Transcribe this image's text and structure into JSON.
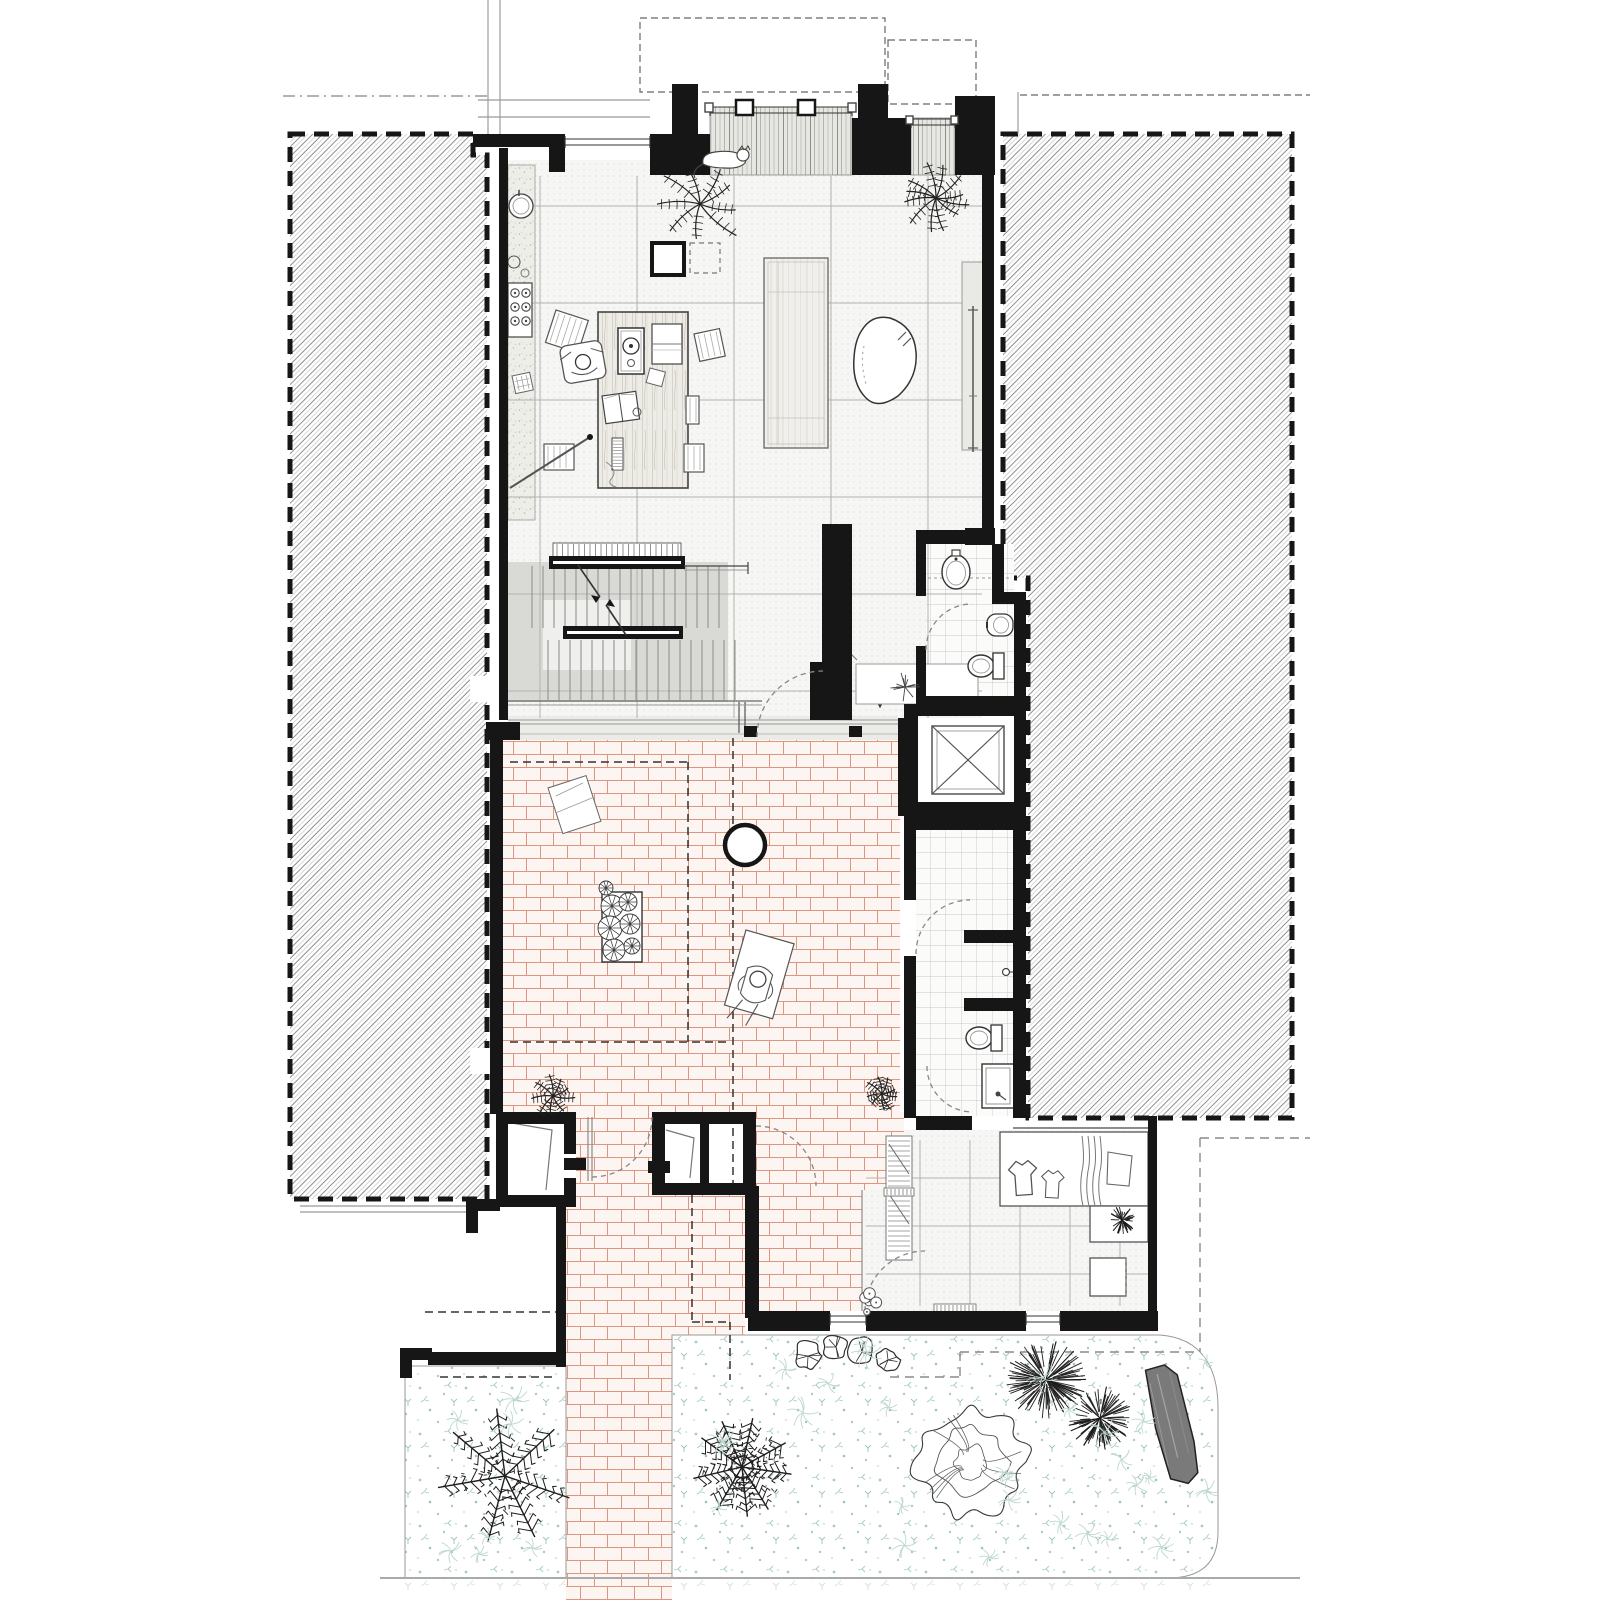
{
  "document": {
    "kind": "architectural ground floor plan",
    "visible_text": [],
    "notes": "line drawing, no labels or dimensions visible"
  },
  "colors": {
    "wall": "#161616",
    "line_dark": "#333333",
    "line_mid": "#777777",
    "line_light": "#aaaaaa",
    "hatch": "#8f8f8f",
    "tile_bg": "#f6f6f4",
    "tile_dot": "#c9c9c3",
    "grid": "#b2b2ad",
    "stair_grey": "#d9d9d6",
    "deck_bg": "#e6e6e2",
    "deck_line": "#a8a8a2",
    "brick_joint": "#dd9680",
    "brick_bg": "#fdf5f1",
    "teal": "#a6cdbf",
    "teal_light": "#bdd8cc",
    "wood_bg": "#edece7",
    "wood_line": "#c9c5b8",
    "speckle_bg": "#eeeee9",
    "log_fill": "#7a7a7a"
  },
  "canvas": {
    "width": 1600,
    "height": 1600
  },
  "hatch_blocks": [
    {
      "name": "party-wall-left",
      "path": "M290,134 L473,134 L473,155 L487,155 L487,1199 L290,1199 Z"
    },
    {
      "name": "party-wall-right",
      "path": "M1003,134 L1292,134 L1292,1118 L1028,1118 L1028,578 L1003,578 Z"
    }
  ],
  "hatch_notches": [
    [
      470,
      676,
      20,
      26
    ],
    [
      470,
      1048,
      20,
      26
    ]
  ],
  "floors": {
    "main_tile": [
      508,
      160,
      474,
      558
    ],
    "kitchen_strip": [
      508,
      165,
      27,
      355
    ],
    "deck_bays": [
      [
        710,
        107,
        142,
        68
      ],
      [
        911,
        118,
        44,
        57
      ]
    ],
    "threshold": [
      508,
      716,
      390,
      24
    ],
    "stair_grey": [
      508,
      562,
      220,
      140
    ],
    "stair_landing": [
      543,
      600,
      88,
      70
    ],
    "wc_tile": [
      926,
      544,
      88,
      152
    ],
    "bath_tile": [
      916,
      830,
      97,
      286
    ],
    "laundry_tile": [
      [
        904,
        1130,
        244,
        60
      ],
      [
        862,
        1190,
        286,
        121
      ]
    ],
    "shaft_inner": [
      932,
      726,
      72,
      68
    ],
    "bricks": [
      [
        503,
        736,
        397,
        376
      ],
      [
        576,
        1112,
        76,
        83
      ],
      [
        756,
        1112,
        148,
        78
      ],
      [
        759,
        1186,
        103,
        125
      ],
      [
        566,
        1195,
        179,
        140
      ],
      [
        566,
        1335,
        106,
        265
      ]
    ],
    "bed_left": [
      405,
      1366,
      161,
      212
    ],
    "bed_right_path": "M672,1335 L1160,1335 C1202,1338 1218,1368 1218,1408 L1218,1532 Q1218,1578 1168,1578 L672,1578 Z",
    "teal_below": [
      [
        405,
        1578,
        161,
        14
      ],
      [
        672,
        1578,
        546,
        14
      ]
    ]
  },
  "grids": {
    "main": {
      "vx": [
        540,
        637,
        734,
        831,
        928
      ],
      "vy1": 176,
      "vy2": 718,
      "hy": [
        206,
        303,
        400,
        497,
        594,
        691
      ],
      "hx1": 508,
      "hx2": 982
    },
    "laundry": {
      "vx": [
        920,
        970,
        1020,
        1070,
        1120
      ],
      "vy1": 1140,
      "vy2": 1306,
      "hy": [
        1178,
        1226,
        1274
      ],
      "hx1": 866,
      "hx2": 1148
    }
  },
  "walls": [
    [
      473,
      134,
      92,
      13
    ],
    [
      549,
      147,
      16,
      25
    ],
    [
      499,
      148,
      9,
      572
    ],
    [
      672,
      84,
      26,
      52
    ],
    [
      650,
      134,
      60,
      41
    ],
    [
      858,
      84,
      30,
      36
    ],
    [
      852,
      118,
      59,
      57
    ],
    [
      955,
      96,
      40,
      79
    ],
    [
      982,
      175,
      12,
      353
    ],
    [
      965,
      528,
      30,
      17
    ],
    [
      916,
      530,
      51,
      14
    ],
    [
      992,
      544,
      12,
      50
    ],
    [
      992,
      592,
      34,
      12
    ],
    [
      1014,
      592,
      12,
      120
    ],
    [
      916,
      696,
      104,
      10
    ],
    [
      916,
      530,
      10,
      66
    ],
    [
      916,
      646,
      10,
      60
    ],
    [
      904,
      704,
      14,
      112
    ],
    [
      916,
      704,
      104,
      12
    ],
    [
      1014,
      704,
      12,
      112
    ],
    [
      904,
      802,
      122,
      14
    ],
    [
      822,
      524,
      30,
      196
    ],
    [
      810,
      662,
      14,
      58
    ],
    [
      490,
      736,
      13,
      378
    ],
    [
      486,
      722,
      34,
      18
    ],
    [
      898,
      718,
      20,
      98
    ],
    [
      904,
      815,
      112,
      15
    ],
    [
      904,
      830,
      12,
      70
    ],
    [
      904,
      956,
      12,
      162
    ],
    [
      1013,
      815,
      13,
      303
    ],
    [
      964,
      930,
      50,
      13
    ],
    [
      964,
      998,
      50,
      13
    ],
    [
      916,
      1116,
      56,
      14
    ],
    [
      1148,
      1116,
      9,
      202
    ],
    [
      745,
      1186,
      14,
      132
    ],
    [
      748,
      1311,
      82,
      20
    ],
    [
      866,
      1311,
      160,
      20
    ],
    [
      1060,
      1311,
      98,
      20
    ],
    [
      496,
      1112,
      80,
      12
    ],
    [
      496,
      1112,
      12,
      95
    ],
    [
      496,
      1195,
      80,
      12
    ],
    [
      564,
      1112,
      12,
      42
    ],
    [
      564,
      1178,
      12,
      29
    ],
    [
      564,
      1158,
      22,
      12
    ],
    [
      652,
      1112,
      104,
      12
    ],
    [
      652,
      1112,
      13,
      83
    ],
    [
      652,
      1183,
      104,
      12
    ],
    [
      743,
      1112,
      13,
      83
    ],
    [
      700,
      1124,
      9,
      59
    ],
    [
      648,
      1161,
      22,
      12
    ],
    [
      556,
      1195,
      10,
      172
    ],
    [
      466,
      1199,
      34,
      12
    ],
    [
      466,
      1199,
      12,
      34
    ],
    [
      400,
      1348,
      32,
      12
    ],
    [
      400,
      1348,
      12,
      30
    ],
    [
      428,
      1352,
      138,
      13
    ],
    [
      744,
      726,
      13,
      11
    ],
    [
      849,
      726,
      13,
      11
    ]
  ],
  "thin_lines": [
    {
      "x1": 488,
      "y1": 0,
      "x2": 488,
      "y2": 134,
      "c": "#888",
      "w": 1
    },
    {
      "x1": 500,
      "y1": 0,
      "x2": 500,
      "y2": 134,
      "c": "#888",
      "w": 1
    },
    {
      "x1": 478,
      "y1": 100,
      "x2": 650,
      "y2": 100,
      "c": "#999",
      "w": 1.2
    },
    {
      "x1": 478,
      "y1": 117,
      "x2": 650,
      "y2": 117,
      "c": "#999",
      "w": 1.2
    },
    {
      "x1": 1018,
      "y1": 92,
      "x2": 1018,
      "y2": 134,
      "c": "#888",
      "w": 1
    },
    {
      "x1": 300,
      "y1": 1206,
      "x2": 466,
      "y2": 1206,
      "c": "#999",
      "w": 1.2
    },
    {
      "x1": 300,
      "y1": 1212,
      "x2": 466,
      "y2": 1212,
      "c": "#999",
      "w": 1.2
    },
    {
      "x1": 380,
      "y1": 1578,
      "x2": 1300,
      "y2": 1578,
      "c": "#aaa",
      "w": 2
    },
    {
      "x1": 862,
      "y1": 1190,
      "x2": 862,
      "y2": 1311,
      "c": "#777",
      "w": 1
    },
    {
      "x1": 1013,
      "y1": 1128,
      "x2": 1148,
      "y2": 1128,
      "c": "#666",
      "w": 1.5
    },
    {
      "x1": 508,
      "y1": 720,
      "x2": 898,
      "y2": 720,
      "c": "#999",
      "w": 1
    },
    {
      "x1": 508,
      "y1": 724,
      "x2": 898,
      "y2": 724,
      "c": "#999",
      "w": 1
    },
    {
      "x1": 508,
      "y1": 734,
      "x2": 898,
      "y2": 734,
      "c": "#bbb",
      "w": 1
    },
    {
      "x1": 739,
      "y1": 702,
      "x2": 739,
      "y2": 733,
      "c": "#555",
      "w": 1.2
    },
    {
      "x1": 745,
      "y1": 702,
      "x2": 745,
      "y2": 733,
      "c": "#555",
      "w": 1.2
    },
    {
      "x1": 508,
      "y1": 701,
      "x2": 762,
      "y2": 701,
      "c": "#666",
      "w": 1.2
    },
    {
      "x1": 508,
      "y1": 705,
      "x2": 762,
      "y2": 705,
      "c": "#999",
      "w": 1
    },
    {
      "x1": 684,
      "y1": 566,
      "x2": 748,
      "y2": 566,
      "c": "#444",
      "w": 1.2
    },
    {
      "x1": 684,
      "y1": 570,
      "x2": 748,
      "y2": 570,
      "c": "#999",
      "w": 1
    },
    {
      "x1": 748,
      "y1": 562,
      "x2": 748,
      "y2": 574,
      "c": "#444",
      "w": 1.2
    }
  ],
  "windows": [
    {
      "x1": 565,
      "y": 139,
      "x2": 650
    },
    {
      "x1": 710,
      "y": 107,
      "x2": 852
    },
    {
      "x1": 911,
      "y": 119,
      "x2": 955
    },
    {
      "x1": 830,
      "y": 1316,
      "x2": 866
    },
    {
      "x1": 1026,
      "y": 1316,
      "x2": 1060
    }
  ],
  "mullions": [
    [
      736,
      100,
      17,
      15
    ],
    [
      798,
      100,
      17,
      15
    ]
  ],
  "end_squares": [
    [
      705,
      103,
      8,
      9
    ],
    [
      848,
      103,
      8,
      9
    ],
    [
      906,
      116,
      7,
      8
    ],
    [
      951,
      116,
      7,
      8
    ]
  ],
  "dashed": {
    "heavy": [
      "M290,134 L473,134 L473,155 L487,155 L487,1199 L290,1199 Z",
      "M1003,134 L1292,134 L1292,1118 L1028,1118 L1028,578 L1003,578 Z"
    ],
    "fine_rects": [
      [
        640,
        18,
        245,
        74
      ],
      [
        888,
        40,
        88,
        64
      ]
    ],
    "fine_lines": [
      [
        1020,
        95,
        1310,
        95
      ]
    ],
    "dashdot": [
      [
        283,
        96,
        488,
        96
      ]
    ],
    "pergola": [
      [
        688,
        762,
        688,
        1042
      ],
      [
        733,
        738,
        733,
        1186
      ],
      [
        510,
        762,
        688,
        762
      ],
      [
        510,
        1042,
        726,
        1042
      ],
      [
        692,
        1195,
        692,
        1322
      ],
      [
        692,
        1322,
        730,
        1322
      ],
      [
        730,
        1322,
        730,
        1380
      ],
      [
        425,
        1312,
        556,
        1312
      ],
      [
        440,
        1377,
        556,
        1377
      ]
    ],
    "site_grey": [
      [
        1200,
        1138,
        1200,
        1352
      ],
      [
        1200,
        1138,
        1310,
        1138
      ],
      [
        960,
        1352,
        1200,
        1352
      ],
      [
        960,
        1352,
        960,
        1377
      ],
      [
        890,
        1377,
        960,
        1377
      ]
    ],
    "wc_shelf": [
      [
        922,
        578,
        1010,
        578
      ]
    ]
  },
  "door_arcs": [
    "M757,737 A66,66 0 0 1 823,671",
    "M926,650 A46,46 0 0 1 972,604",
    "M916,954 A54,54 0 0 1 970,900",
    "M927,1066 A46,46 0 0 0 973,1112",
    "M865,1311 A60,60 0 0 1 925,1251",
    "M756,1126 A60,60 0 0 1 816,1186",
    "M592,1177 A60,60 0 0 0 652,1117"
  ],
  "stairs": {
    "comb": [
      553,
      543,
      128,
      14
    ],
    "bar1": [
      549,
      556,
      136,
      13
    ],
    "bar2": [
      563,
      626,
      120,
      13
    ],
    "treads_upper": {
      "x1": 532,
      "x2": 726,
      "y1": 566,
      "y2": 628,
      "step": 11
    },
    "treads_lower": {
      "x1": 548,
      "x2": 737,
      "y1": 640,
      "y2": 700,
      "step": 11
    },
    "break_line": [
      [
        578,
        565,
        600,
        597
      ],
      [
        606,
        605,
        626,
        635
      ]
    ]
  },
  "furniture": {
    "desk": [
      598,
      312,
      90,
      176
    ],
    "island": [
      764,
      258,
      64,
      190
    ],
    "bench": [
      962,
      262,
      24,
      188
    ],
    "rug_blob": "M862,330 Q872,314 890,318 Q914,326 916,352 Q918,378 898,396 Q878,410 866,398 Q852,384 854,358 Q855,340 862,330 Z",
    "column_square": [
      652,
      243,
      32,
      32
    ],
    "dashed_square": [
      690,
      243,
      30,
      30
    ],
    "round_table": {
      "cx": 745,
      "cy": 845,
      "r": 20
    },
    "hall_table": {
      "cx": 880,
      "cy": 688,
      "r": 13.5
    },
    "niche": [
      856,
      664,
      122,
      40
    ],
    "blanket": {
      "x": 548,
      "y": 788,
      "w": 40,
      "h": 48,
      "rot": -18
    },
    "planter": [
      602,
      892,
      40,
      70
    ],
    "lounger": {
      "x": 746,
      "y": 930,
      "w": 50,
      "h": 78,
      "rot": 16
    },
    "counter": [
      1000,
      1132,
      148,
      74
    ],
    "counter_leg": [
      1090,
      1206,
      58,
      36
    ],
    "appliance": [
      1090,
      1258,
      36,
      38
    ],
    "shelf_strip": [
      886,
      1136,
      26,
      124
    ],
    "combs": [
      [
        934,
        1304,
        42,
        10
      ],
      [
        884,
        1188,
        30,
        8
      ]
    ],
    "stools": [
      {
        "x": 556,
        "y": 310,
        "w": 34,
        "h": 34,
        "rot": 18
      },
      {
        "x": 694,
        "y": 334,
        "w": 26,
        "h": 28,
        "rot": -12
      },
      {
        "x": 686,
        "y": 396,
        "w": 13,
        "h": 28,
        "rot": 0
      },
      {
        "x": 684,
        "y": 444,
        "w": 20,
        "h": 28,
        "rot": 0
      },
      {
        "x": 544,
        "y": 444,
        "w": 30,
        "h": 26,
        "rot": 0
      }
    ],
    "desk_items": {
      "record_box": [
        618,
        328,
        26,
        46
      ],
      "book": [
        652,
        324,
        30,
        40
      ],
      "paper_tilt": {
        "x": 650,
        "y": 368,
        "w": 16,
        "h": 15,
        "rot": 15
      },
      "open_book": {
        "x": 602,
        "y": 396,
        "w": 34,
        "h": 28,
        "rot": -8
      },
      "ruler": [
        612,
        438,
        11,
        32
      ],
      "small_circle": {
        "cx": 637,
        "cy": 412,
        "r": 4
      }
    },
    "pole": {
      "x1": 510,
      "y1": 488,
      "x2": 590,
      "y2": 437
    },
    "papers_floor": {
      "x": 512,
      "y": 376,
      "w": 18,
      "h": 18,
      "rot": -12
    },
    "oar": {
      "x": 973,
      "y1": 306,
      "y2": 452
    },
    "door_leaves": [
      [
        [
          506,
          1122
        ],
        [
          552,
          1130
        ],
        [
          546,
          1190
        ]
      ],
      [
        [
          666,
          1130
        ],
        [
          694,
          1138
        ],
        [
          690,
          1178
        ]
      ]
    ],
    "gate_lines": [
      [
        588,
        1117,
        588,
        1181
      ],
      [
        592,
        1117,
        592,
        1181
      ]
    ]
  },
  "kitchen": {
    "sink": {
      "cx": 521,
      "cy": 206,
      "r": 12
    },
    "kettle": {
      "cx": 514,
      "cy": 262,
      "r": 6
    },
    "dish": {
      "cx": 525,
      "cy": 273,
      "r": 4
    },
    "hob": [
      508,
      283,
      24,
      54
    ],
    "burners": [
      [
        515,
        293
      ],
      [
        526,
        293
      ],
      [
        515,
        307
      ],
      [
        526,
        307
      ],
      [
        515,
        321
      ],
      [
        526,
        321
      ]
    ]
  },
  "fixtures": {
    "wc_basin": {
      "cx": 956,
      "cy": 572
    },
    "wc_bidet": {
      "cx": 1000,
      "cy": 625
    },
    "wc_toilet": {
      "cx": 986,
      "cy": 666
    },
    "bath_tap": {
      "cx": 1006,
      "cy": 972
    },
    "bath_toilet": {
      "cx": 984,
      "cy": 1038
    },
    "bath_sink": [
      982,
      1064,
      32,
      44
    ],
    "shaft_x": [
      932,
      726,
      72,
      68
    ]
  },
  "laundry_items": {
    "shirts": [
      {
        "x": 1008,
        "y": 1162,
        "s": 1.0,
        "rot": -4
      },
      {
        "x": 1042,
        "y": 1170,
        "s": 0.8,
        "rot": 3
      }
    ],
    "towel": [
      1078,
      1136,
      26,
      70
    ],
    "cloth": [
      1106,
      1148,
      28,
      36
    ]
  },
  "figures": {
    "cat": {
      "x": 725,
      "y": 160
    },
    "desk_person": {
      "x": 583,
      "y": 362
    },
    "lounge_person": {
      "x": 746,
      "y": 930,
      "rot": 16
    }
  },
  "vegetation": [
    {
      "type": "palm",
      "x": 700,
      "y": 204,
      "r": 46
    },
    {
      "type": "fern",
      "x": 936,
      "y": 198,
      "r": 36
    },
    {
      "type": "plant",
      "x": 905,
      "y": 687,
      "r": 15
    },
    {
      "type": "palm",
      "x": 553,
      "y": 1096,
      "r": 22
    },
    {
      "type": "palm",
      "x": 882,
      "y": 1094,
      "r": 18
    },
    {
      "type": "spiky",
      "x": 1122,
      "y": 1220,
      "r": 14
    },
    {
      "type": "rosettes",
      "x": 621,
      "y": 926
    },
    {
      "type": "frond",
      "x": 505,
      "y": 1476,
      "r": 68,
      "dense": false
    },
    {
      "type": "frond",
      "x": 742,
      "y": 1467,
      "r": 50,
      "dense": true
    },
    {
      "type": "scribble",
      "x": 972,
      "y": 1462,
      "r": 56
    },
    {
      "type": "spiky",
      "x": 1046,
      "y": 1380,
      "r": 40
    },
    {
      "type": "spiky",
      "x": 1100,
      "y": 1418,
      "r": 32
    },
    {
      "type": "bush",
      "x": 808,
      "y": 1356,
      "r": 15
    },
    {
      "type": "bush",
      "x": 836,
      "y": 1347,
      "r": 13
    },
    {
      "type": "bush",
      "x": 862,
      "y": 1352,
      "r": 14
    },
    {
      "type": "bush",
      "x": 888,
      "y": 1360,
      "r": 12
    },
    {
      "type": "flowers",
      "x": 865,
      "y": 1298,
      "r": 16
    },
    {
      "type": "log",
      "x": 1168,
      "y": 1426
    }
  ],
  "scatter_beds": [
    [
      412,
      1372,
      146,
      196
    ],
    [
      682,
      1342,
      526,
      226
    ]
  ]
}
